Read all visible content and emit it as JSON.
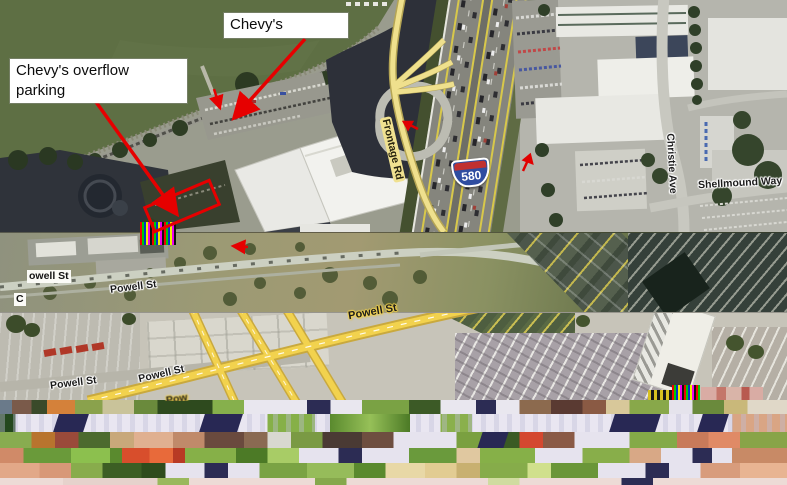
{
  "annotations": {
    "chevys": "Chevy's",
    "overflow": "Chevy's overflow parking",
    "accent_color": "#e60000"
  },
  "roads": {
    "frontage": "Frontage Rd",
    "shield_number": "580",
    "christie": "Christie Ave",
    "shellmound": "Shellmound Way",
    "powell_box_fragment": "owell St",
    "powell_band2": "Powell St",
    "c_fragment": "C",
    "powell_band3_left": "Powell St",
    "powell_band3_mid": "Powell St",
    "powell_band3_yellow": "Powell St",
    "pow_fragment": "Pow"
  },
  "colors": {
    "water": "#5e6f44",
    "annotation_red": "#e60000",
    "road_yellow": "#f0d14a",
    "shield_blue": "#2f4da0",
    "shield_red": "#c03030"
  }
}
